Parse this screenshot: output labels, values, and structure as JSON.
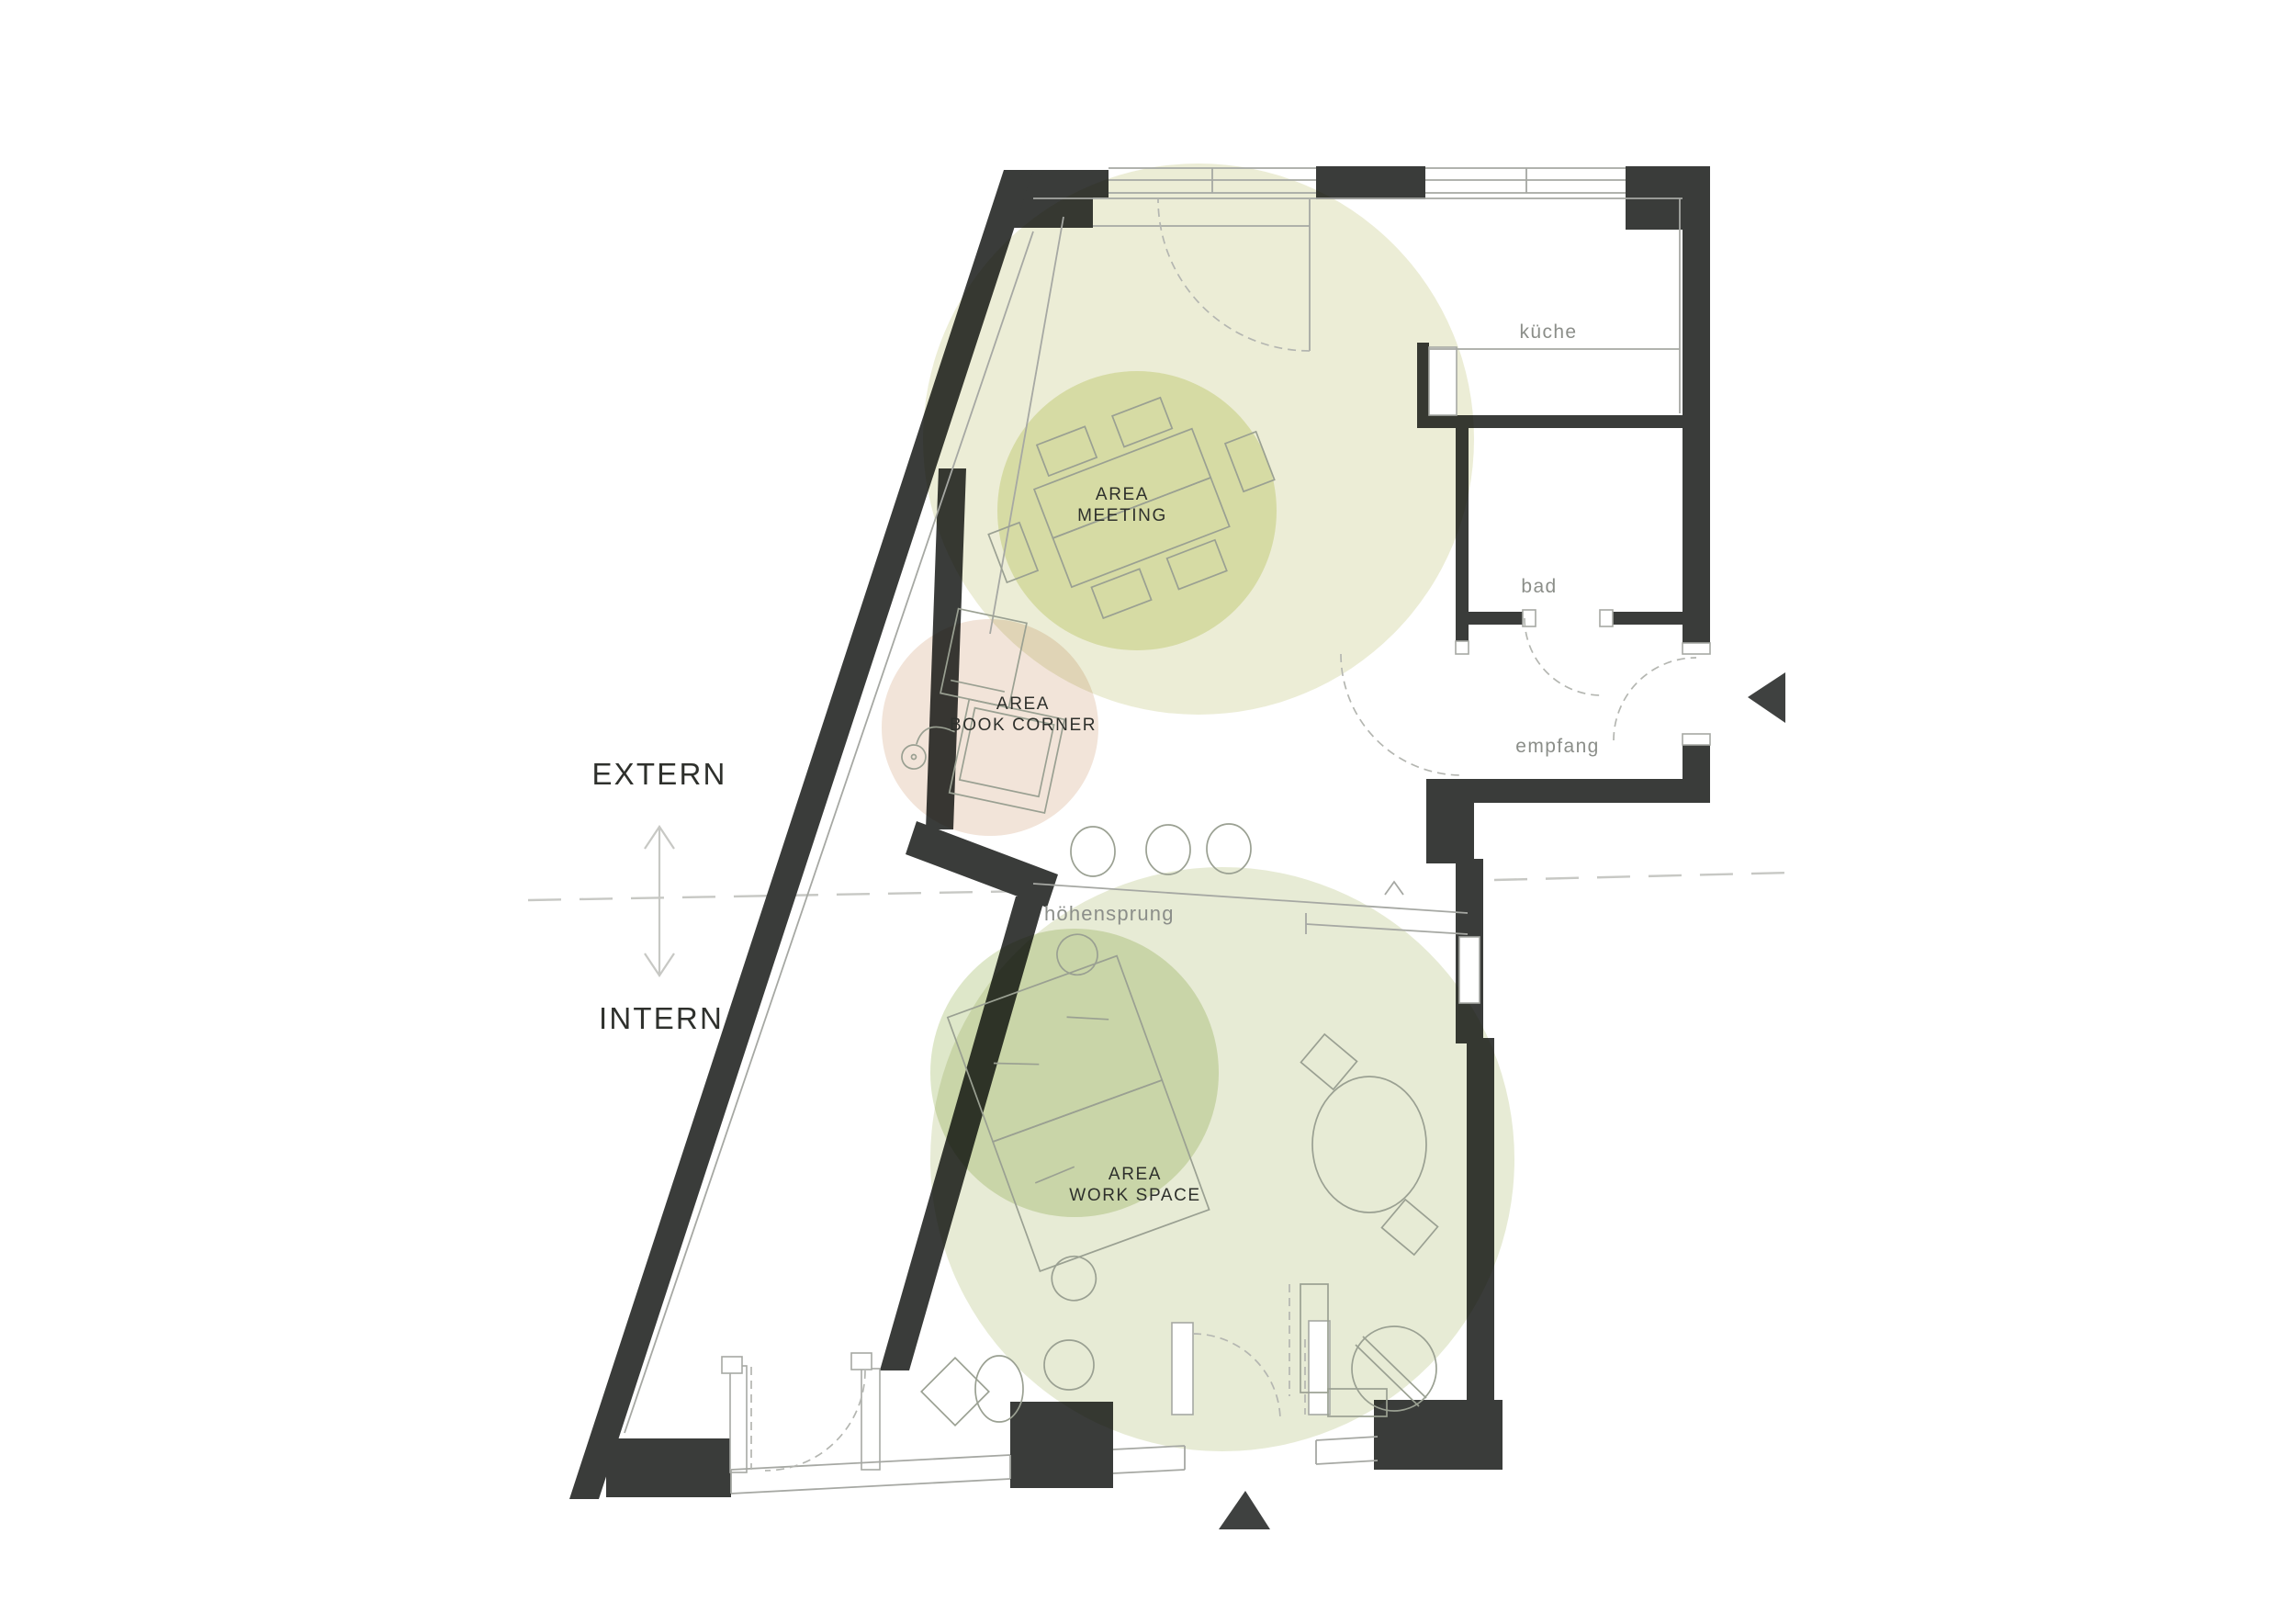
{
  "zones": {
    "meeting": {
      "label_line1": "AREA",
      "label_line2": "MEETING"
    },
    "book_corner": {
      "label_line1": "AREA",
      "label_line2": "BOOK CORNER"
    },
    "work_space": {
      "label_line1": "AREA",
      "label_line2": "WORK SPACE"
    }
  },
  "rooms": {
    "kitchen": "küche",
    "bathroom": "bad",
    "reception": "empfang"
  },
  "markers": {
    "level_change": "höhensprung",
    "above_section_line": "EXTERN",
    "below_section_line": "INTERN"
  },
  "colors": {
    "wall": "#3a3c3a",
    "line": "#a6a8a3",
    "dash": "#b4b6b1",
    "furniture": "#9aa092",
    "guide": "#c7c8c4",
    "label_dark": "#2e302c",
    "label_gray": "#8b8e89",
    "triangle": "#3f4140",
    "zone_meeting_outer": "#ecedd6",
    "zone_meeting_inner": "#e8ecc4",
    "zone_book_corner": "#f2e4d9",
    "zone_work_outer": "#e7ebd5",
    "zone_work_inner": "#dee7c9"
  }
}
